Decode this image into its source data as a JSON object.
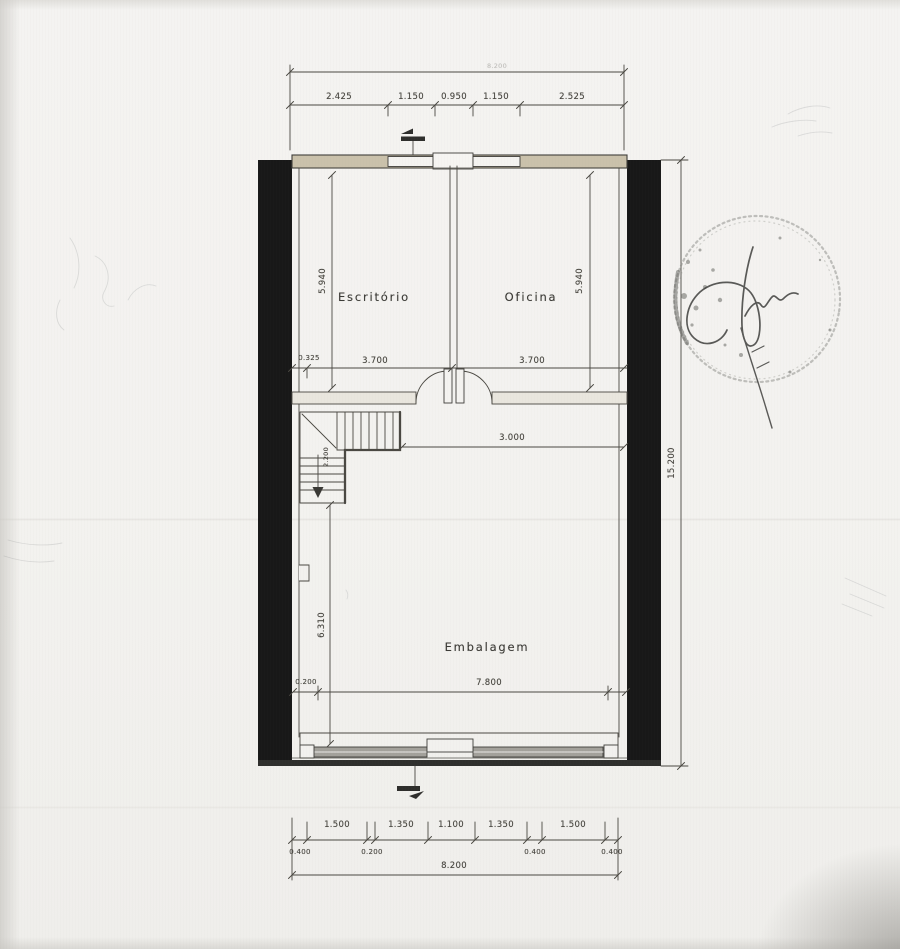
{
  "rooms": {
    "escritorio": "Escritório",
    "oficina": "Oficina",
    "embalagem": "Embalagem"
  },
  "dims": {
    "top_total": "8.200",
    "top": [
      "2.425",
      "1.150",
      "0.950",
      "1.150",
      "2.525"
    ],
    "height_left": "5.940",
    "height_right": "5.940",
    "mid": [
      "0.325",
      "3.700",
      "3.700"
    ],
    "hall_width": "3.000",
    "stair_width": "2.200",
    "embalagem_height": "6.310",
    "bottom_inner": [
      "0.200",
      "7.800"
    ],
    "overall_height": "15.200",
    "footing_row1": [
      "1.500",
      "1.350",
      "1.100",
      "1.350",
      "1.500"
    ],
    "footing_row2": [
      "0.400",
      "0.200",
      "0.400",
      "0.400"
    ],
    "footing_total": "8.200"
  },
  "colors": {
    "ink": "#4a4842",
    "wall_poche": "#181818",
    "wall_band": "#cac1ab",
    "glazing": "#a3a19b",
    "paper": "#f3f2ef"
  }
}
